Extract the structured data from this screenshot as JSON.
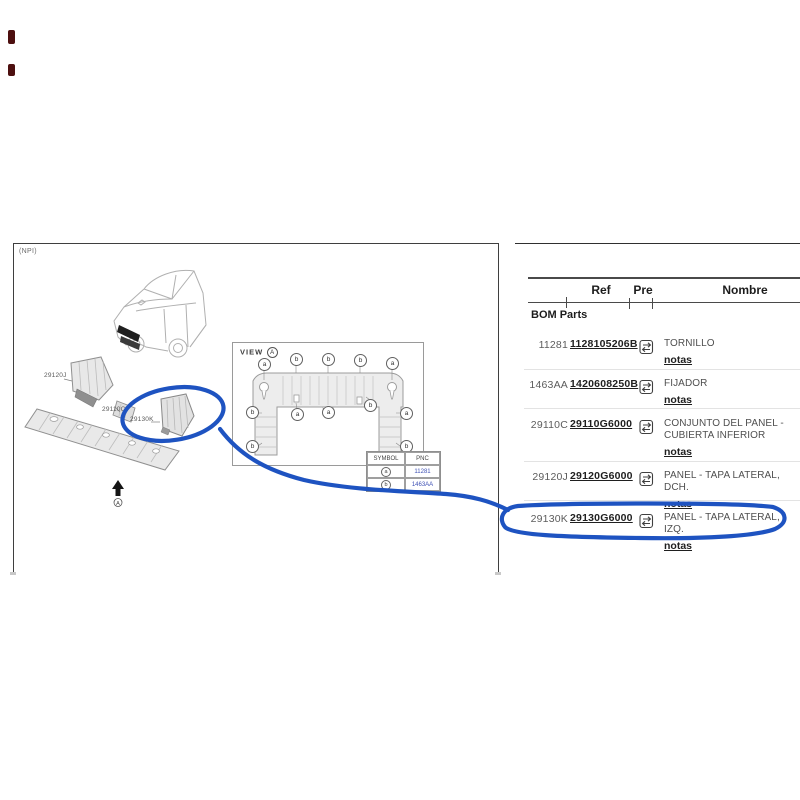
{
  "page": {
    "npi_label": "(NPI)"
  },
  "colors": {
    "annotation": "#1e53c1",
    "pnc_link": "#3f51b5"
  },
  "diagram": {
    "part_labels": [
      {
        "text": "29120J"
      },
      {
        "text": "29110C"
      },
      {
        "text": "29130K"
      }
    ],
    "direction_marker_letter": "A",
    "view": {
      "title": "VIEW",
      "view_letter": "A",
      "callouts": [
        "a",
        "b",
        "b",
        "b",
        "a",
        "b",
        "a",
        "a",
        "b",
        "a",
        "b",
        "b"
      ],
      "symbol_table": {
        "headers": {
          "symbol": "SYMBOL",
          "pnc": "PNC"
        },
        "rows": [
          {
            "symbol": "a",
            "pnc": "11281"
          },
          {
            "symbol": "b",
            "pnc": "1463AA"
          }
        ]
      }
    }
  },
  "table": {
    "section_label": "BOM Parts",
    "headers": {
      "ref": "Ref",
      "pre": "Pre",
      "nombre": "Nombre"
    },
    "rows": [
      {
        "ref": "11281",
        "pre": "1128105206B",
        "name": "TORNILLO",
        "notes": "notas"
      },
      {
        "ref": "1463AA",
        "pre": "1420608250B",
        "name": "FIJADOR",
        "notes": "notas"
      },
      {
        "ref": "29110C",
        "pre": "29110G6000",
        "name": "CONJUNTO DEL PANEL - CUBIERTA INFERIOR",
        "notes": "notas"
      },
      {
        "ref": "29120J",
        "pre": "29120G6000",
        "name": "PANEL - TAPA LATERAL, DCH.",
        "notes": "notas"
      },
      {
        "ref": "29130K",
        "pre": "29130G6000",
        "name": "PANEL - TAPA LATERAL, IZQ.",
        "notes": "notas"
      }
    ]
  }
}
